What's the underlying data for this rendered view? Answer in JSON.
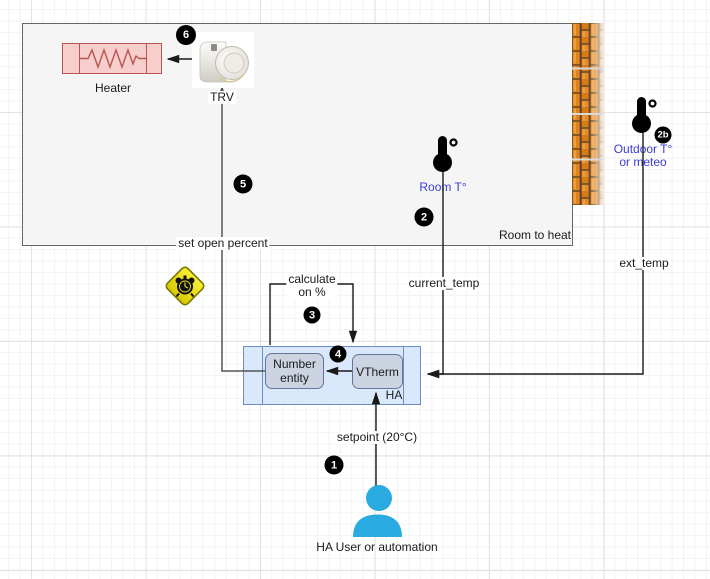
{
  "diagram": {
    "room": {
      "label": "Room to heat"
    },
    "heater": {
      "label": "Heater"
    },
    "trv": {
      "label": "TRV"
    },
    "sensors": {
      "room_temp_label": "Room T°",
      "outdoor_label_line1": "Outdoor T°",
      "outdoor_label_line2": "or meteo"
    },
    "edges": {
      "set_open_percent": "set open percent",
      "calculate_line1": "calculate",
      "calculate_line2": "on %",
      "current_temp": "current_temp",
      "ext_temp": "ext_temp",
      "setpoint": "setpoint (20°C)"
    },
    "ha": {
      "label": "HA",
      "number_entity_line1": "Number",
      "number_entity_line2": "entity",
      "vtherm_label": "VTherm"
    },
    "user": {
      "label": "HA User or automation"
    },
    "badges": {
      "1": "1",
      "2": "2",
      "2b": "2b",
      "3": "3",
      "4": "4",
      "5": "5",
      "6": "6"
    },
    "icons": {
      "trv_device": "trv-device-icon",
      "brick_wall": "brick-wall-icon",
      "room_thermometer": "thermometer-icon",
      "outdoor_thermometer": "thermometer-icon",
      "warning": "alarm-clock-warning-icon",
      "user": "person-icon"
    },
    "colors": {
      "room_fill": "#f5f5f5",
      "room_border": "#666666",
      "heater_fill": "#f8cecc",
      "heater_border": "#b85450",
      "ha_fill": "#dae8fc",
      "ha_border": "#6c8ebf",
      "entity_fill": "#ccd4e2",
      "entity_border": "#66749c",
      "label_blue": "#3b3bd9",
      "user_blue": "#29abe2",
      "badge_bg": "#000000",
      "badge_fg": "#ffffff",
      "warning_yellow": "#f0e31c",
      "brick_orange": "#e0821f"
    }
  }
}
